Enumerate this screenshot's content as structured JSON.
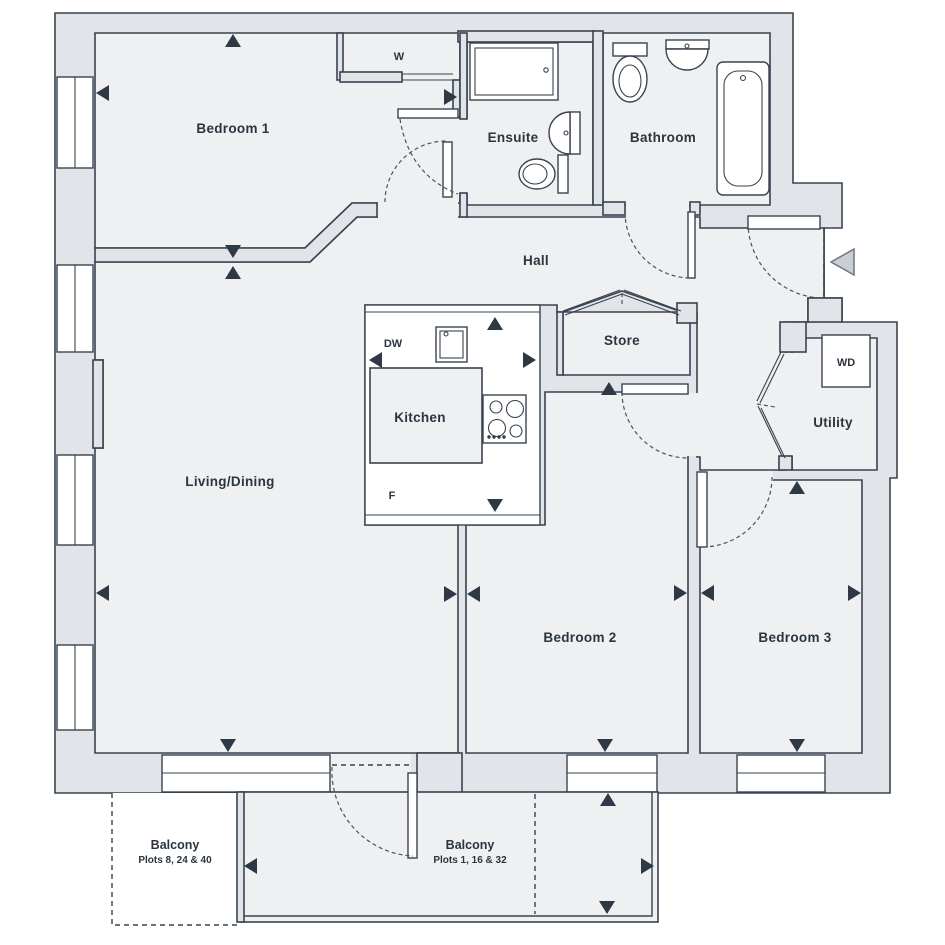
{
  "plan_title": "Apartment floor plan",
  "rooms": {
    "bedroom1": "Bedroom 1",
    "ensuite": "Ensuite",
    "bathroom": "Bathroom",
    "hall": "Hall",
    "store": "Store",
    "kitchen": "Kitchen",
    "living_dining": "Living/Dining",
    "utility": "Utility",
    "bedroom2": "Bedroom 2",
    "bedroom3": "Bedroom 3"
  },
  "appliances": {
    "wardrobe": "W",
    "dishwasher": "DW",
    "fridge": "F",
    "washer_dryer": "WD"
  },
  "balconies": {
    "left": {
      "name": "Balcony",
      "plots": "Plots 8, 24 & 40"
    },
    "right": {
      "name": "Balcony",
      "plots": "Plots 1, 16 & 32"
    }
  },
  "colors": {
    "wall_fill": "#e1e4e9",
    "floor_fill": "#eef0f2",
    "line": "#39434f",
    "arrow": "#2e3945",
    "entry_arrow_fill": "#c9ced4"
  }
}
